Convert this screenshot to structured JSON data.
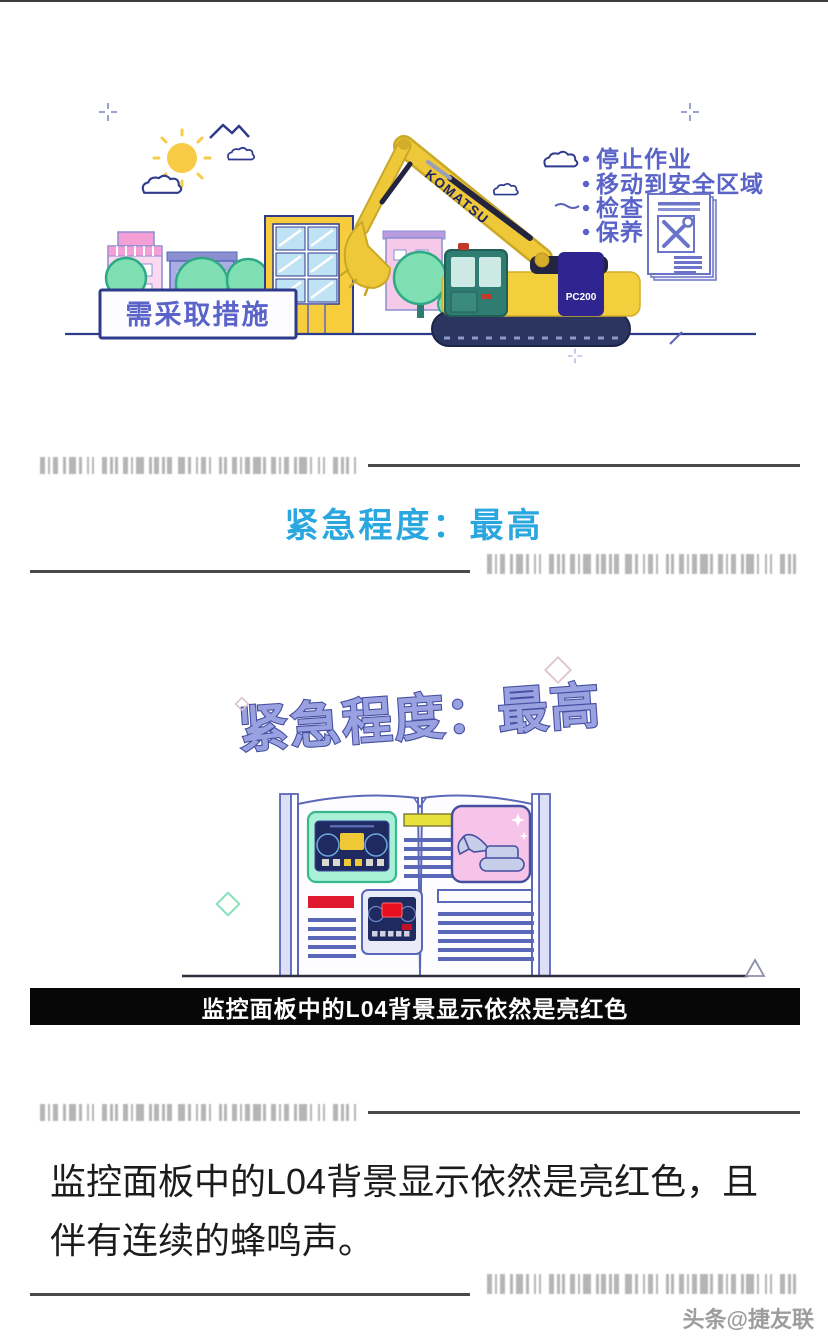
{
  "hero": {
    "sign_label": "需采取措施",
    "brand_label": "KOMATSU",
    "model_label": "PC200",
    "checklist": [
      "停止作业",
      "移动到安全区域",
      "检查",
      "保养"
    ]
  },
  "urgency": {
    "heading": "紧急程度：最高",
    "heading_color": "#2BA7E0"
  },
  "manual": {
    "title": "紧急程度：最高",
    "caption": "监控面板中的L04背景显示依然是亮红色"
  },
  "article": {
    "body": "监控面板中的L04背景显示依然是亮红色，且伴有连续的蜂鸣声。"
  },
  "footer": {
    "watermark": "头条@捷友联"
  },
  "colors": {
    "heading_blue": "#2BA7E0",
    "title_purple": "#99A1E0",
    "alert_red": "#DF1A2E",
    "warning_yellow": "#EFC838",
    "caption_bar": "#070707",
    "barcode_gray": "#A6A6A6",
    "excavator_yellow": "#F3CE3D",
    "cab_teal": "#2F7C72"
  }
}
